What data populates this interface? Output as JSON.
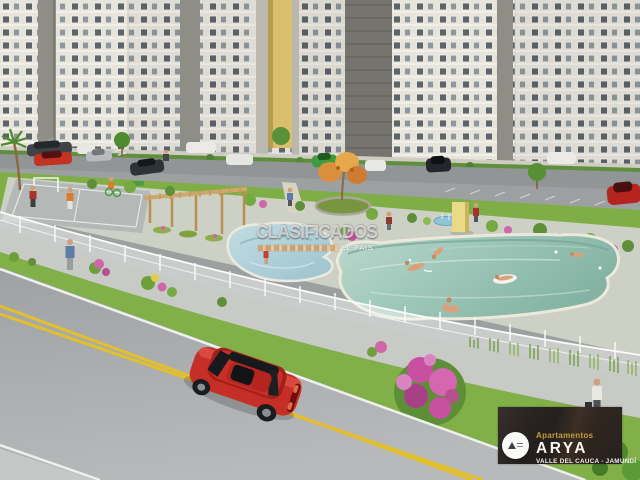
{
  "watermark": {
    "text": "CLASIFICADOS",
    "bar_text": "EL PAÍS"
  },
  "badge": {
    "brand_line": "Apartamentos",
    "name": "ARYA",
    "location": "VALLE DEL CAUCA - JAMUNDÍ",
    "logo_icon": "arya-mountain-logo-icon"
  },
  "colors": {
    "badge_gold": "#c59d3f",
    "badge_background": "#2c2623",
    "watermark_bar_orange": "#d59452",
    "pool_water": "#9fc8ba",
    "kids_pool_water": "#b7d7de",
    "grass_green": "#82b048",
    "road_gray": "#a8abad",
    "road_line_yellow": "#e3c02b",
    "red_car": "#c62f28",
    "building_face": "#e7e4dc",
    "pergola_wood": "#c9a36a"
  },
  "scene": {
    "elements": [
      "apartment-towers",
      "parking-lot-cars",
      "sports-court",
      "wooden-pergola",
      "orange-flower-tree-fountain",
      "kids-pool",
      "main-pool",
      "yellow-feature-wall",
      "white-perimeter-fence",
      "sidewalk-pedestrians",
      "flower-verge-bougainvillea",
      "street-double-yellow-line",
      "red-sedan"
    ]
  }
}
